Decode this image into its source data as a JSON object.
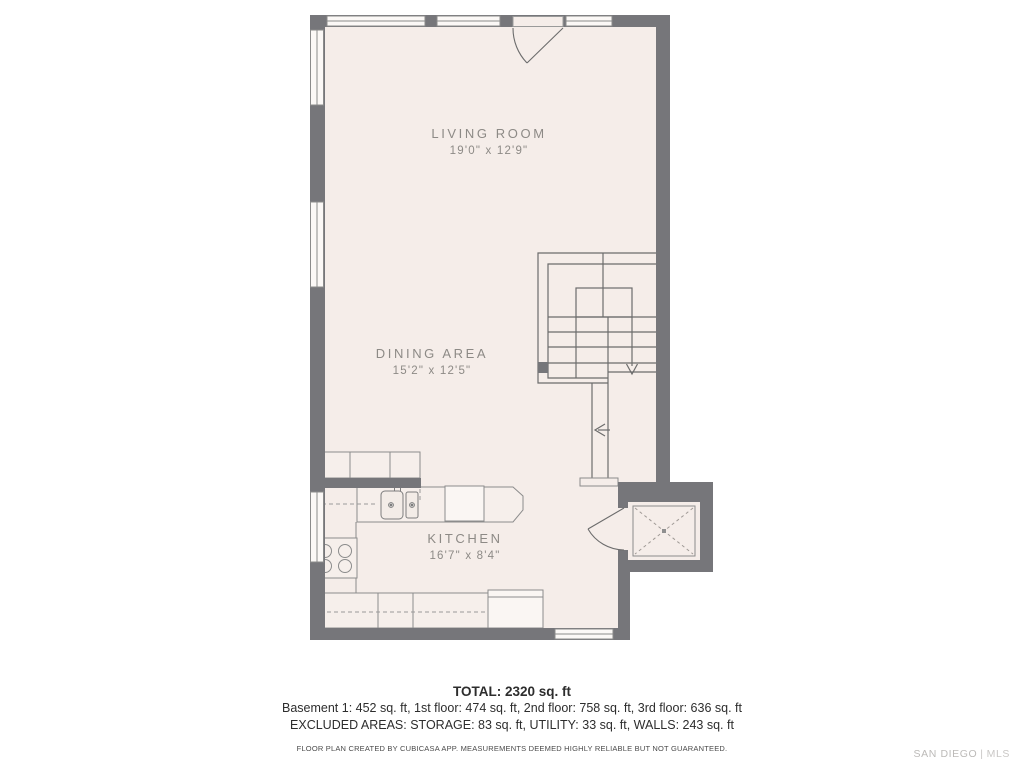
{
  "plan": {
    "rooms": [
      {
        "name": "LIVING ROOM",
        "dims": "19'0\" x 12'9\""
      },
      {
        "name": "DINING AREA",
        "dims": "15'2\" x 12'5\""
      },
      {
        "name": "KITCHEN",
        "dims": "16'7\" x 8'4\""
      }
    ]
  },
  "summary": {
    "total": "TOTAL: 2320 sq. ft",
    "floors": "Basement 1: 452 sq. ft, 1st floor: 474 sq. ft, 2nd floor: 758 sq. ft, 3rd floor: 636 sq. ft",
    "excluded": "EXCLUDED AREAS: STORAGE: 83 sq. ft, UTILITY: 33 sq. ft, WALLS: 243 sq. ft"
  },
  "disclaimer": "FLOOR PLAN CREATED BY CUBICASA APP. MEASUREMENTS DEEMED HIGHLY RELIABLE BUT NOT GUARANTEED.",
  "watermark": {
    "brand": "SAN DIEGO",
    "separator": "|",
    "suffix": "MLS"
  },
  "colors": {
    "wall": "#76767a",
    "floor": "#f5ede9",
    "counter": "#f6efeb",
    "window": "#fbf8f6"
  }
}
